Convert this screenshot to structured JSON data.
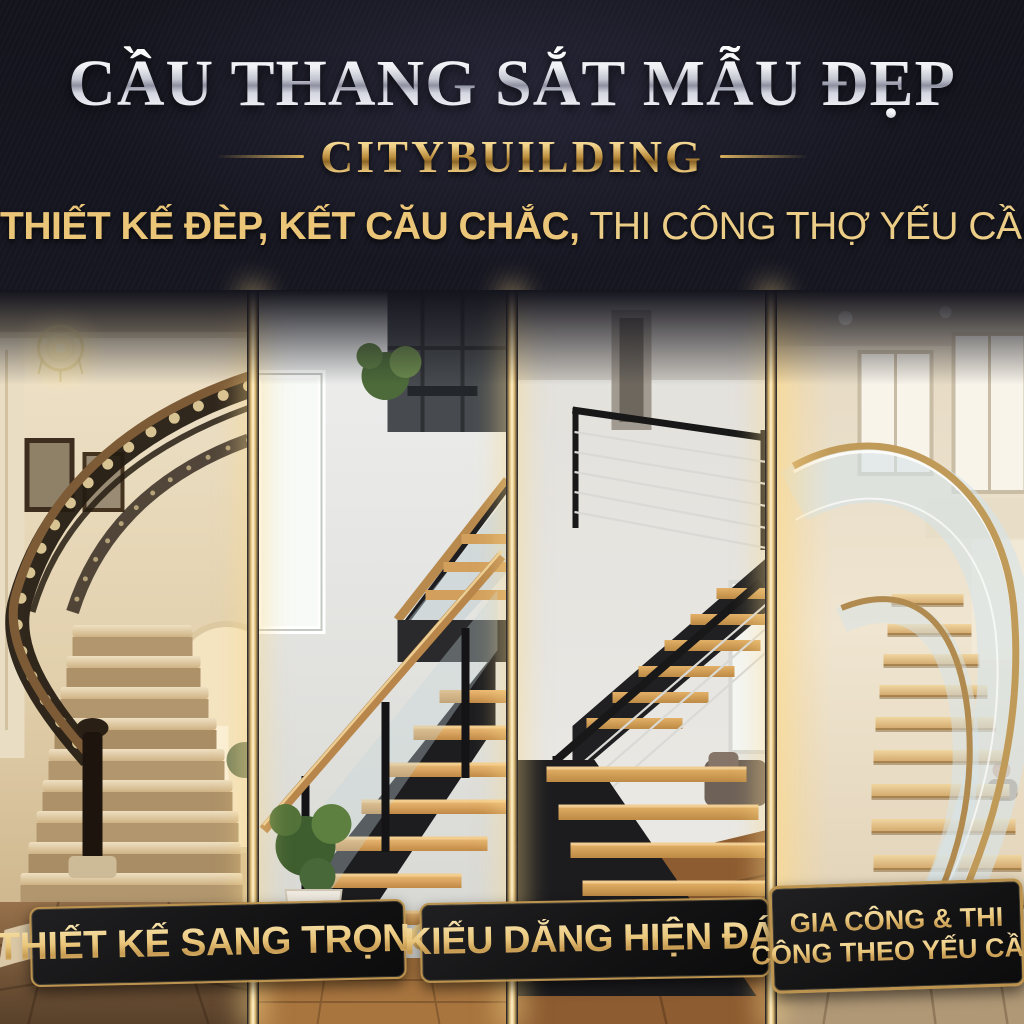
{
  "poster_title": "CẦU THANG SẮT MẪU ĐẸP",
  "brand": "CITYBUILDING",
  "tagline": {
    "bold": "THIẾT KẾ ĐÈP, KẾT CĂU CHẮC,",
    "regular": "THI CÔNG THỢ YẾU CẦU"
  },
  "badges": [
    {
      "label": "THIẾT KẾ SANG TRỌNG"
    },
    {
      "label": "KIẾU DẮNG HIỆN ĐÁI"
    },
    {
      "line1": "GIA CÔNG & THI",
      "line2": "CÔNG THEO YẾU CẦU"
    }
  ],
  "photos": [
    {
      "description": "Luxury curved staircase with ornate black wrought-iron scroll railing, marble steps, chandelier, framed paintings and arched doorway"
    },
    {
      "description": "Modern staircase with black steel stringers, oak treads, glass panels, wood handrail, window and potted plant in white-gold pot"
    },
    {
      "description": "Black steel switchback staircase with open oak treads and thin horizontal cable railing over wood floor"
    },
    {
      "description": "Curved helical staircase with bent glass balustrade, bronze handrail and light oak treads in warm light"
    }
  ],
  "colors": {
    "background_navy": "#14141d",
    "title_silver": "#e9e9ee",
    "gold": "#d8b05e",
    "gold_bright": "#fff3cd",
    "badge_background": "#121213",
    "badge_border": "#bb934e",
    "badge_text_gold": "#eac77c"
  }
}
